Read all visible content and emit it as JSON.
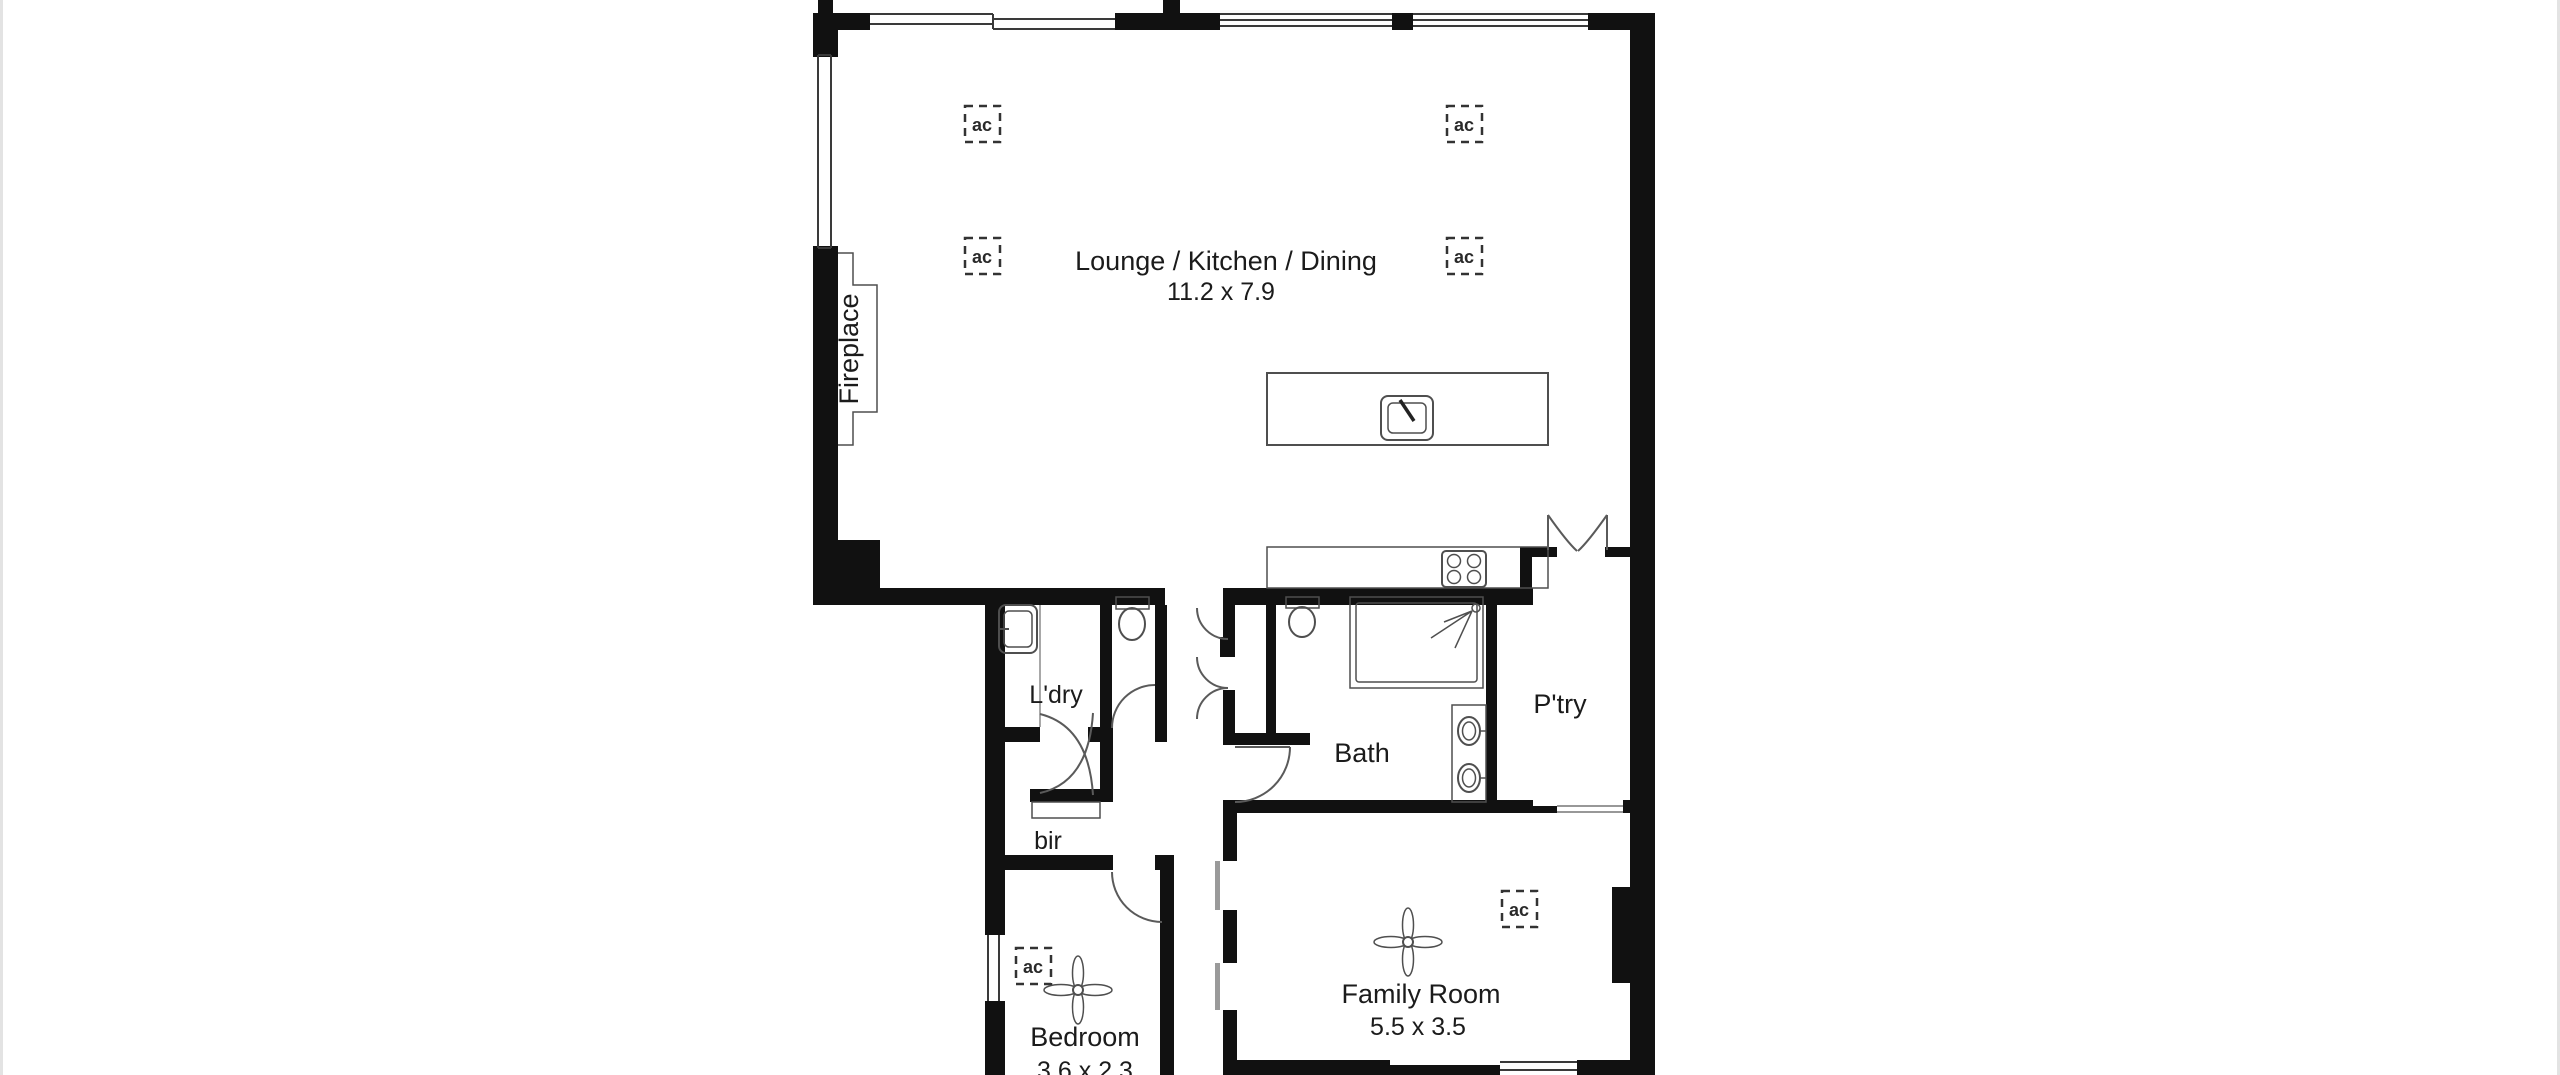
{
  "image": {
    "type": "residential floor plan",
    "background": "#ffffff"
  },
  "colors": {
    "wall": "#111111",
    "win": "#3a3a3a",
    "fix": "#4f4f4f",
    "door": "#5a5a5a",
    "text": "#1b1b1b",
    "bg": "#ffffff",
    "edge": "#e3e3e3"
  },
  "labels": {
    "ac": "ac"
  },
  "rooms": {
    "lounge": {
      "name": "Lounge / Kitchen / Dining",
      "dimensions": "11.2 x 7.9"
    },
    "family": {
      "name": "Family Room",
      "dimensions": "5.5 x 3.5"
    },
    "bedroom": {
      "name": "Bedroom",
      "dimensions": "3.6 x 2.3"
    },
    "laundry": {
      "name": "L'dry"
    },
    "bath": {
      "name": "Bath"
    },
    "pantry": {
      "name": "P'try"
    },
    "robe": {
      "name": "bir"
    },
    "fireplace": {
      "name": "Fireplace"
    }
  }
}
